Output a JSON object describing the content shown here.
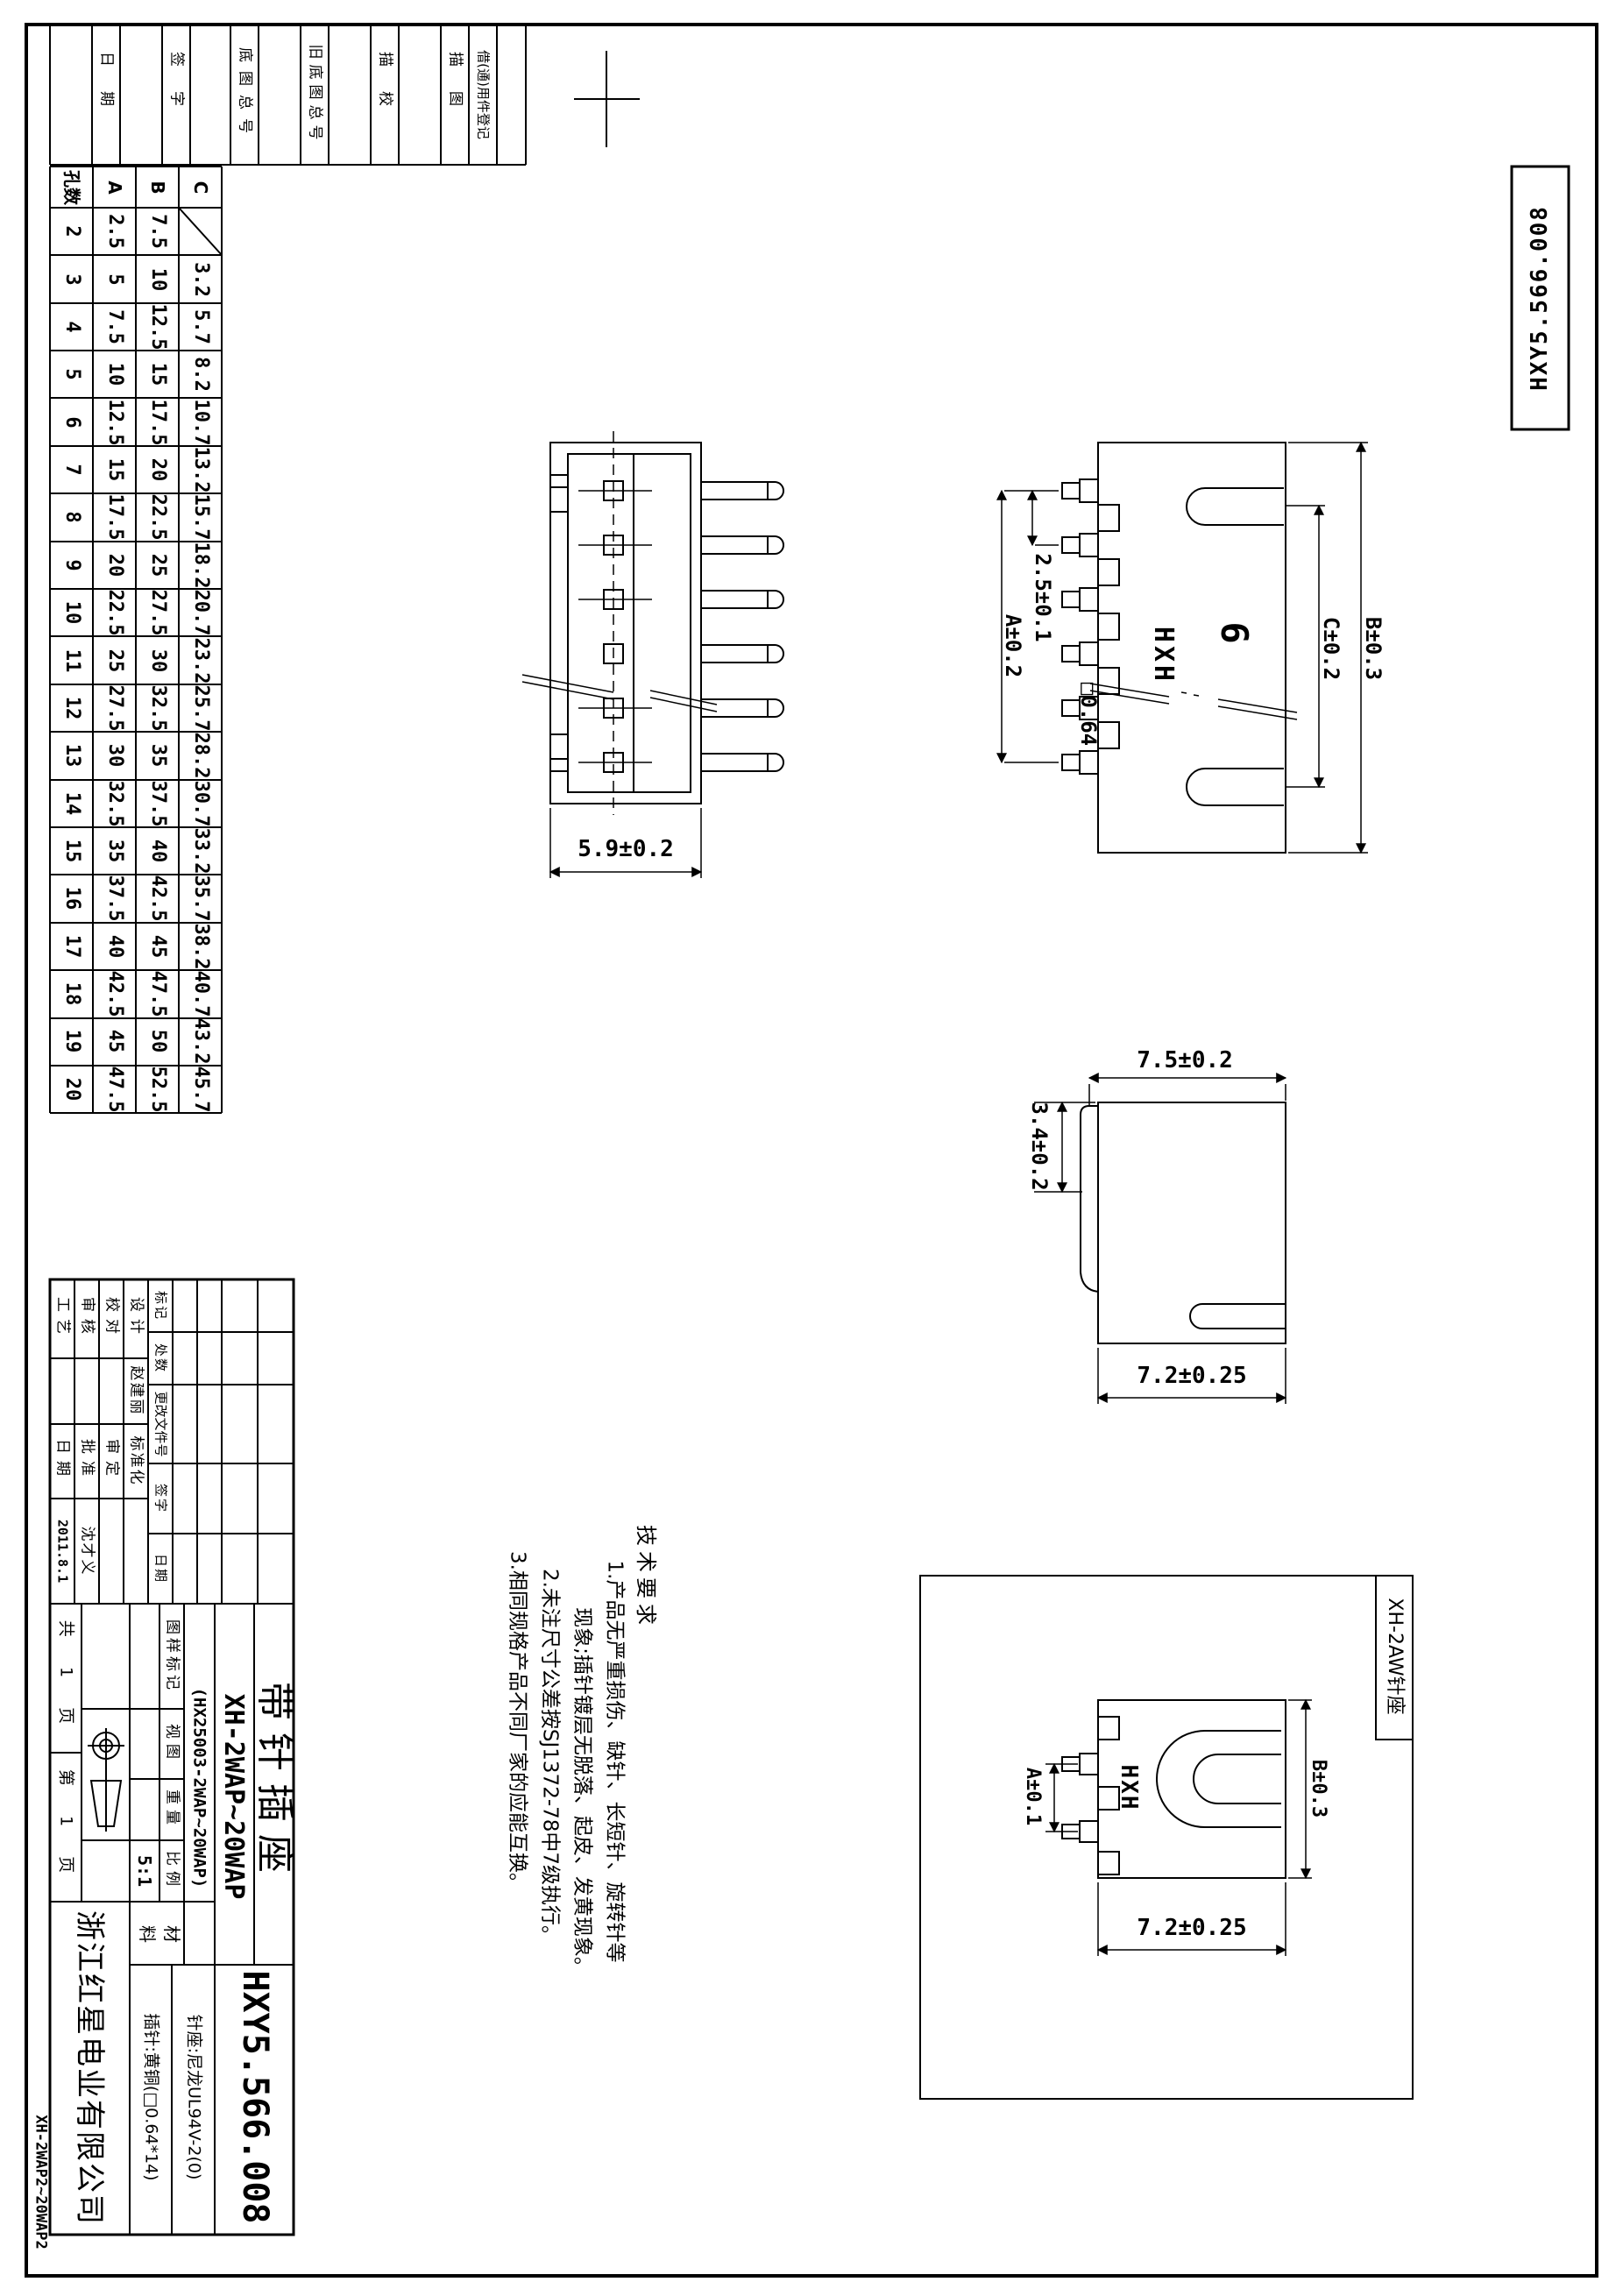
{
  "sheet": {
    "drawing_no_corner": "HXY5.566.008",
    "side_code": "XH-2WAP2~20WAP2"
  },
  "header_strips": {
    "items": [
      "日期",
      "签字",
      "底图总号",
      "旧底图总号",
      "描校",
      "描图",
      "借(通)用件登记"
    ]
  },
  "dim_table": {
    "headers": [
      "孔数",
      "A",
      "B",
      "C"
    ],
    "rows": [
      [
        "2",
        "2.5",
        "7.5",
        ""
      ],
      [
        "3",
        "5",
        "10",
        "3.2"
      ],
      [
        "4",
        "7.5",
        "12.5",
        "5.7"
      ],
      [
        "5",
        "10",
        "15",
        "8.2"
      ],
      [
        "6",
        "12.5",
        "17.5",
        "10.7"
      ],
      [
        "7",
        "15",
        "20",
        "13.2"
      ],
      [
        "8",
        "17.5",
        "22.5",
        "15.7"
      ],
      [
        "9",
        "20",
        "25",
        "18.2"
      ],
      [
        "10",
        "22.5",
        "27.5",
        "20.7"
      ],
      [
        "11",
        "25",
        "30",
        "23.2"
      ],
      [
        "12",
        "27.5",
        "32.5",
        "25.7"
      ],
      [
        "13",
        "30",
        "35",
        "28.2"
      ],
      [
        "14",
        "32.5",
        "37.5",
        "30.7"
      ],
      [
        "15",
        "35",
        "40",
        "33.2"
      ],
      [
        "16",
        "37.5",
        "42.5",
        "35.7"
      ],
      [
        "17",
        "40",
        "45",
        "38.2"
      ],
      [
        "18",
        "42.5",
        "47.5",
        "40.7"
      ],
      [
        "19",
        "45",
        "50",
        "43.2"
      ],
      [
        "20",
        "47.5",
        "52.5",
        "45.7"
      ]
    ]
  },
  "tech_notes": {
    "title": "技术要求",
    "lines": [
      "1.产品无严重损伤、缺针、长短针、旋转针等",
      "现象;插针镀层无脱落、起皮、发黄现象。",
      "2.未注尺寸公差按SJ1372-78中7级执行。",
      "3.相同规格产品不同厂家的应能互换。"
    ]
  },
  "views": {
    "side_view": {
      "width_dim": "5.9±0.2"
    },
    "front_view": {
      "brand": "HXH",
      "pin_count": "6",
      "pitch_dim": "2.5±0.1",
      "a_dim": "A±0.2",
      "pin_square_dim": "□0.64",
      "c_dim": "C±0.2",
      "b_dim": "B±0.3"
    },
    "profile_view": {
      "top_dim": "7.5±0.2",
      "left_dim": "3.4±0.2",
      "bottom_dim": "7.2±0.25"
    },
    "detail_view": {
      "label": "XH-2AW针座",
      "brand": "HXH",
      "a_dim": "A±0.1",
      "b_dim": "B±0.3",
      "bottom_dim": "7.2±0.25"
    }
  },
  "title_block": {
    "roles": {
      "gongyi": "工艺",
      "shenhe": "审核",
      "jiaodui": "校对",
      "sheji": "设计",
      "sheji_name": "赵建丽",
      "riqi": "日期",
      "pizhun": "批准",
      "shending": "审定",
      "biaozhunhua": "标准化",
      "date_value": "2011.8.1",
      "pizhun_name": "沈才义"
    },
    "revision": {
      "biaoji": "标记",
      "chushu": "处数",
      "genggai": "更改文件号",
      "qianzi": "签字",
      "riqi": "日期"
    },
    "pages": {
      "total": "共 1 页",
      "current": "第 1 页"
    },
    "stamp": {
      "tuyang_biaoji": "图样标记",
      "shitu": "视图",
      "zhongliang": "重量",
      "bili": "比例",
      "scale_value": "5:1"
    },
    "product": {
      "name": "带针插座",
      "model": "XH-2WAP~20WAP",
      "model_paren": "(HX25003-2WAP~20WAP)",
      "drawing_no": "HXY5.566.008"
    },
    "material": {
      "label_1": "材",
      "label_2": "料",
      "line_1": "针座:尼龙UL94V-2(0)",
      "line_2": "插针:黄铜(□0.64*14)"
    },
    "company": "浙江红星电业有限公司"
  }
}
